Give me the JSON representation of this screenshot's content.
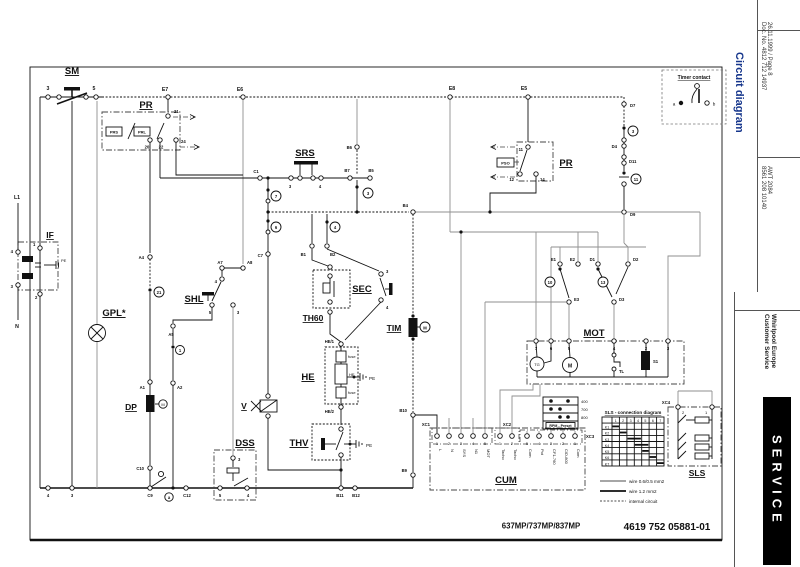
{
  "sidebar": {
    "title": "Circuit diagram",
    "title_color": "#16368c",
    "doc_line1": "26.11.1999 / Page 8",
    "doc_line2": "Doc. No. 4812 712 14937",
    "model_line1": "AWT 2084",
    "model_line2": "8561 208 10140",
    "brand_line1": "Whirlpool Europe",
    "brand_line2": "Customer Service",
    "service": "SERVICE"
  },
  "footer": {
    "models": "637MP/737MP/837MP",
    "code": "4619 752 05881-01"
  },
  "legend": {
    "timer_contact_title": "Timer contact",
    "contact_a": "a",
    "contact_b": "b",
    "wire_thin": "wire 0.6/0.5 mm2",
    "wire_thick": "wire 1.2 mm2",
    "wire_internal": "internal circuit"
  },
  "components": {
    "sm": "SM",
    "pr_left": "PR",
    "if_filter": "IF",
    "gpl": "GPL*",
    "shl": "SHL",
    "srs": "SRS",
    "sec": "SEC",
    "th60": "TH60",
    "tim": "TIM",
    "he": "HE",
    "thv": "THV",
    "dp": "DP",
    "v": "V",
    "dss": "DSS",
    "mot": "MOT",
    "pr_right": "PR",
    "cum": "CUM",
    "sls": "SLS"
  },
  "terminals": {
    "t3": "3",
    "t5": "5",
    "e7": "E7",
    "e6": "E6",
    "e8": "E8",
    "e5": "E5",
    "p21": "21",
    "p20": "20",
    "p22": "22",
    "p24": "24",
    "prs": "PRS",
    "prl": "PRL",
    "l1": "L1",
    "n": "N",
    "if4": "4",
    "if1": "1",
    "if3": "3",
    "if2": "2",
    "pe_if": "PE",
    "a4": "A4",
    "a7": "A7",
    "a8": "A8",
    "shl4": "4",
    "shl5": "5",
    "shl3": "3",
    "a5": "A5",
    "a1": "A1",
    "a2": "A2",
    "c1": "C1",
    "srs3": "3",
    "srs4": "4",
    "b6": "B6",
    "b7": "B7",
    "b5": "B5",
    "b4": "B4",
    "c7": "C7",
    "b1": "B1",
    "b2": "B2",
    "sec3": "3",
    "sec4": "4",
    "he_1": "HE/1",
    "he_2": "HE/2",
    "fuse_top": "fuse",
    "he_mid": "HE",
    "fuse_bot": "fuse",
    "pe_he": "PE",
    "pe_thv": "PE",
    "b10": "B10",
    "b9": "B9",
    "b11": "B11",
    "b12": "B12",
    "c10": "C10",
    "c9": "C9",
    "c12": "C12",
    "dss3": "3",
    "dss5": "5",
    "dss4": "4",
    "bot4": "4",
    "bot3": "3",
    "pr11": "11",
    "pr12": "12",
    "pr14": "14",
    "pso": "PSO",
    "d7": "D7",
    "d4": "D4",
    "d11": "D11",
    "d9": "D9",
    "e1": "E1",
    "e2": "E2",
    "d1": "D1",
    "d2": "D2",
    "e3": "E3",
    "d3": "D3",
    "m7": "7",
    "m6": "6",
    "m5": "5",
    "m4": "4",
    "m2": "2",
    "m3": "3",
    "tg": "TG",
    "m_mot": "M",
    "tl": "TL",
    "s1": "S1",
    "m_tim": "M",
    "m_dp": "M"
  },
  "contacts": {
    "k7": "7",
    "k6": "6",
    "k3": "3",
    "k4": "4",
    "k21": "21",
    "k1": "1",
    "k10": "10",
    "k13": "13",
    "k3r": "3",
    "k11": "11",
    "ka": "a"
  },
  "cum": {
    "label": "CUM",
    "xc1": "XC1",
    "xc2": "XC2",
    "xc3": "XC3",
    "xc1_numbers": [
      "1",
      "2",
      "3",
      "4",
      "5"
    ],
    "xc1_labels": [
      "L",
      "N",
      "SYS",
      "N1",
      "MOT"
    ],
    "xc2_numbers": [
      "1",
      "2"
    ],
    "xc2_labels": [
      "Tacho",
      "Tacho"
    ],
    "xc3_numbers": [
      "5",
      "4",
      "3",
      "2",
      "1"
    ],
    "xc3_labels": [
      "Com",
      "Pot",
      "CF1-760",
      "C/D-800",
      "Com"
    ]
  },
  "rpm": {
    "label": "RPM - Preset",
    "values": [
      "400",
      "700",
      "800"
    ]
  },
  "sls": {
    "label": "SLS",
    "xc4": "XC4",
    "pin2": "2",
    "pin1": "1",
    "table_title": "SLS - connection diagram",
    "cols": [
      "1",
      "2",
      "3",
      "4",
      "5",
      "6",
      "7"
    ],
    "rows": [
      "K1",
      "K2",
      "K3",
      "K4",
      "K5",
      "K6",
      "K7"
    ]
  }
}
